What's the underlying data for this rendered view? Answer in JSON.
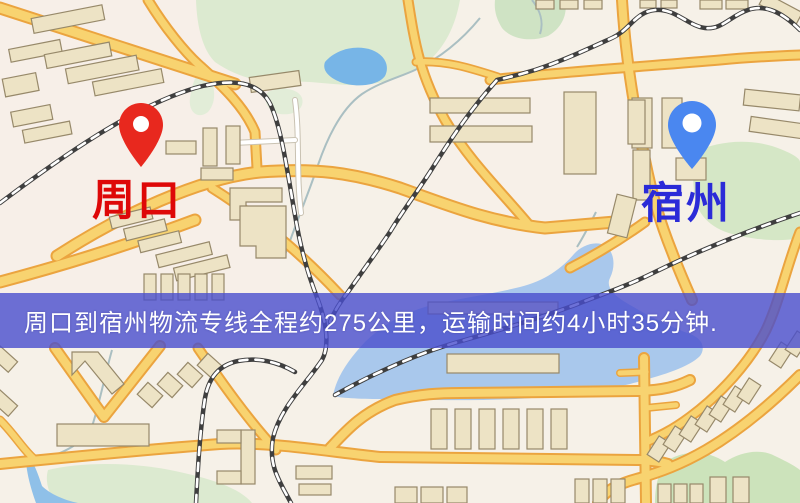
{
  "map": {
    "type": "road-map-graphic",
    "markers": [
      {
        "id": "origin",
        "label": "周口",
        "label_color": "#de0808",
        "pin_color": "#e8281e",
        "pin_icon": "red-location-pin"
      },
      {
        "id": "destination",
        "label": "宿州",
        "label_color": "#2b2bd8",
        "pin_color": "#4a87f0",
        "pin_icon": "blue-location-pin"
      }
    ],
    "banner": {
      "text": "周口到宿州物流专线全程约275公里，运输时间约4小时35分钟.",
      "distance_km": "275",
      "duration": "4小时35分钟",
      "bg_color": "rgba(72,78,205,0.80)",
      "text_color": "#ffffff"
    },
    "palette": {
      "background": "#f6f1e8",
      "road_fill": "#f8d370",
      "road_casing": "#eba43f",
      "minor_road": "#ffffff",
      "water": "#a9c8ec",
      "lake_small": "#77b5e7",
      "park": "#d9e9c8",
      "building_fill": "#ede3c5",
      "building_stroke": "#97896a",
      "railway": "#3f3f3f"
    }
  }
}
